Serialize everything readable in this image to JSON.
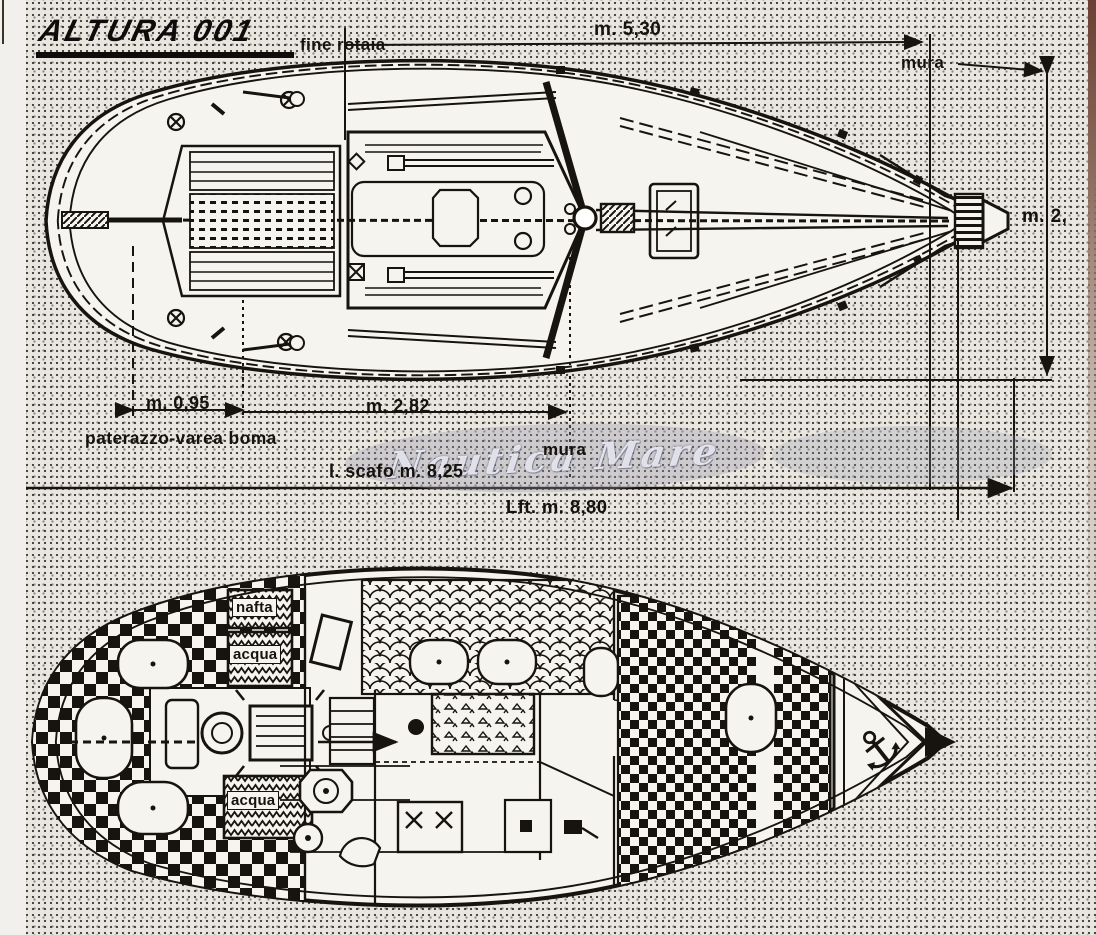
{
  "title": {
    "logo": "ALTURA 001"
  },
  "watermark": {
    "text": "Nautica Mare"
  },
  "deck_plan": {
    "name": "sailboat deck plan - top view",
    "labels": {
      "fine_rotaia": "fine rotaia",
      "mura_top": "mura",
      "mura_bottom": "mura",
      "paterazzo": "paterazzo-varea boma"
    },
    "dimensions": [
      {
        "id": "track-end-to-tack",
        "label": "m. 5,30"
      },
      {
        "id": "beam",
        "label": "m. 2,"
      },
      {
        "id": "stern-to-backstay",
        "label": "m. 0,95"
      },
      {
        "id": "backstay-to-mast",
        "label": "m. 2,82"
      },
      {
        "id": "hull-length",
        "label": "l. scafo m. 8,25"
      },
      {
        "id": "length-overall",
        "label": "Lft. m. 8,80"
      }
    ]
  },
  "interior_plan": {
    "name": "sailboat interior layout - cabin plan",
    "tanks": [
      {
        "id": "fuel-tank",
        "label": "nafta"
      },
      {
        "id": "water-tank-fwd",
        "label": "acqua"
      },
      {
        "id": "water-tank-aft",
        "label": "acqua"
      }
    ],
    "anchor_glyph": "⚓"
  },
  "colors": {
    "paper": "#e9e6e0",
    "hull_fill": "#f6f4ef",
    "ink": "#17130e",
    "watermark": "#9496a8",
    "photo_edge": "#6b3f35"
  }
}
